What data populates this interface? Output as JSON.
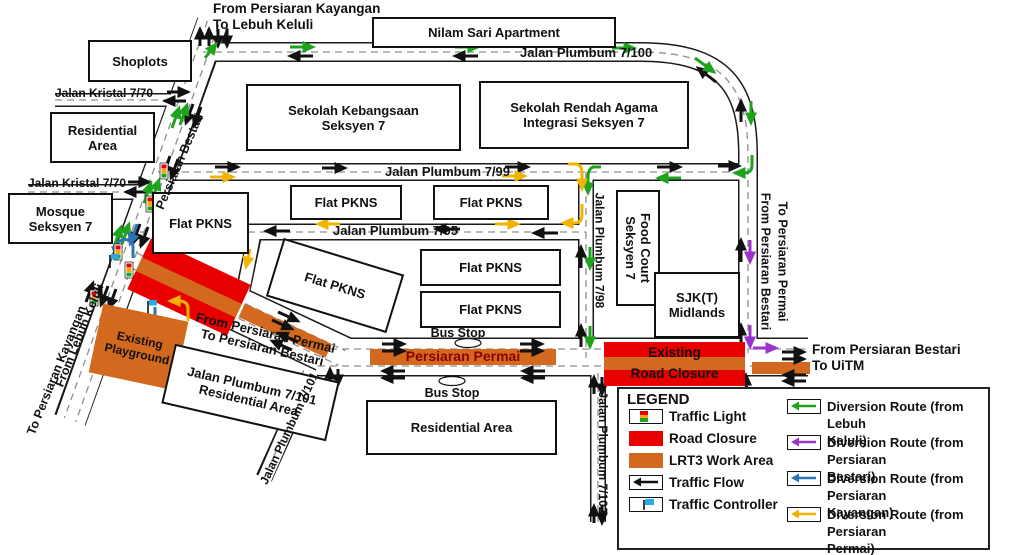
{
  "colors": {
    "road_closure_red": "#E80000",
    "lrt3_orange": "#D2691E",
    "diversion_green": "#1FA31F",
    "diversion_purple": "#9933CC",
    "diversion_blue": "#2E74B5",
    "diversion_yellow": "#F0B400",
    "permai_text": "#8B0000"
  },
  "flow_labels": {
    "top": "From Persiaran Kayangan\nTo Lebuh Keluli",
    "from_permai_to_bestari": "From Persiaran Permai\nTo Persiaran Bestari",
    "from_bestari_vertical": "From Persiaran Bestari",
    "to_permai_vertical": "To Persiaran Permai",
    "to_uitm": "From Persiaran Bestari\nTo UiTM",
    "from_lebuh_keluli": "From Lebuh Keluli",
    "to_persiaran_kayangan": "To Persiaran Kayangan"
  },
  "roads": {
    "persiaran_bestari": "Persiaran Bestari",
    "plumbum_7_100": "Jalan Plumbum 7/100",
    "plumbum_7_99": "Jalan Plumbum 7/99",
    "plumbum_7_95": "Jalan Plumbum 7/95",
    "plumbum_7_98": "Jalan Plumbum 7/98",
    "plumbum_7_101": "Jalan Plumbum 7/101",
    "plumbum_7_102": "Jalan Plumbum 7/102",
    "kristal_7_70_a": "Jalan Kristal 7/70",
    "kristal_7_70_b": "Jalan Kristal 7/70",
    "persiaran_permai": "Persiaran Permai"
  },
  "buildings": {
    "shoplots": "Shoplots",
    "nilam_sari": "Nilam Sari Apartment",
    "residential_nw": "Residential\nArea",
    "mosque": "Mosque\nSeksyen 7",
    "sek_kebangsaan": "Sekolah Kebangsaan\nSeksyen 7",
    "sek_rendah": "Sekolah Rendah Agama\nIntegrasi Seksyen 7",
    "flat_pkns": "Flat PKNS",
    "food_court": "Food Court\nSeksyen 7",
    "sjkt": "SJK(T)\nMidlands",
    "jp101_residential": "Jalan Plumbum 7/101\nResidential Area",
    "residential_s": "Residential Area"
  },
  "areas": {
    "existing_playground": "Existing\nPlayground",
    "existing_road_closure": "Existing\nRoad Closure"
  },
  "poi": {
    "bus_stop": "Bus Stop"
  },
  "legend": {
    "title": "LEGEND",
    "items": [
      {
        "label": "Traffic Light",
        "icon": "traffic-light-icon"
      },
      {
        "label": "Road Closure",
        "icon": "road-closure-swatch"
      },
      {
        "label": "LRT3 Work Area",
        "icon": "lrt3-work-area-swatch"
      },
      {
        "label": "Traffic Flow",
        "icon": "traffic-flow-icon"
      },
      {
        "label": "Traffic Controller",
        "icon": "traffic-controller-icon"
      }
    ],
    "routes": [
      {
        "label": "Diversion Route (from Lebuh\nKeluli)",
        "color": "#1FA31F"
      },
      {
        "label": "Diversion Route (from Persiaran\nBestari)",
        "color": "#9933CC"
      },
      {
        "label": "Diversion Route (from Persiaran\nKayangan)",
        "color": "#2E74B5"
      },
      {
        "label": "Diversion Route (from Persiaran\nPermai)",
        "color": "#F0B400"
      }
    ]
  }
}
